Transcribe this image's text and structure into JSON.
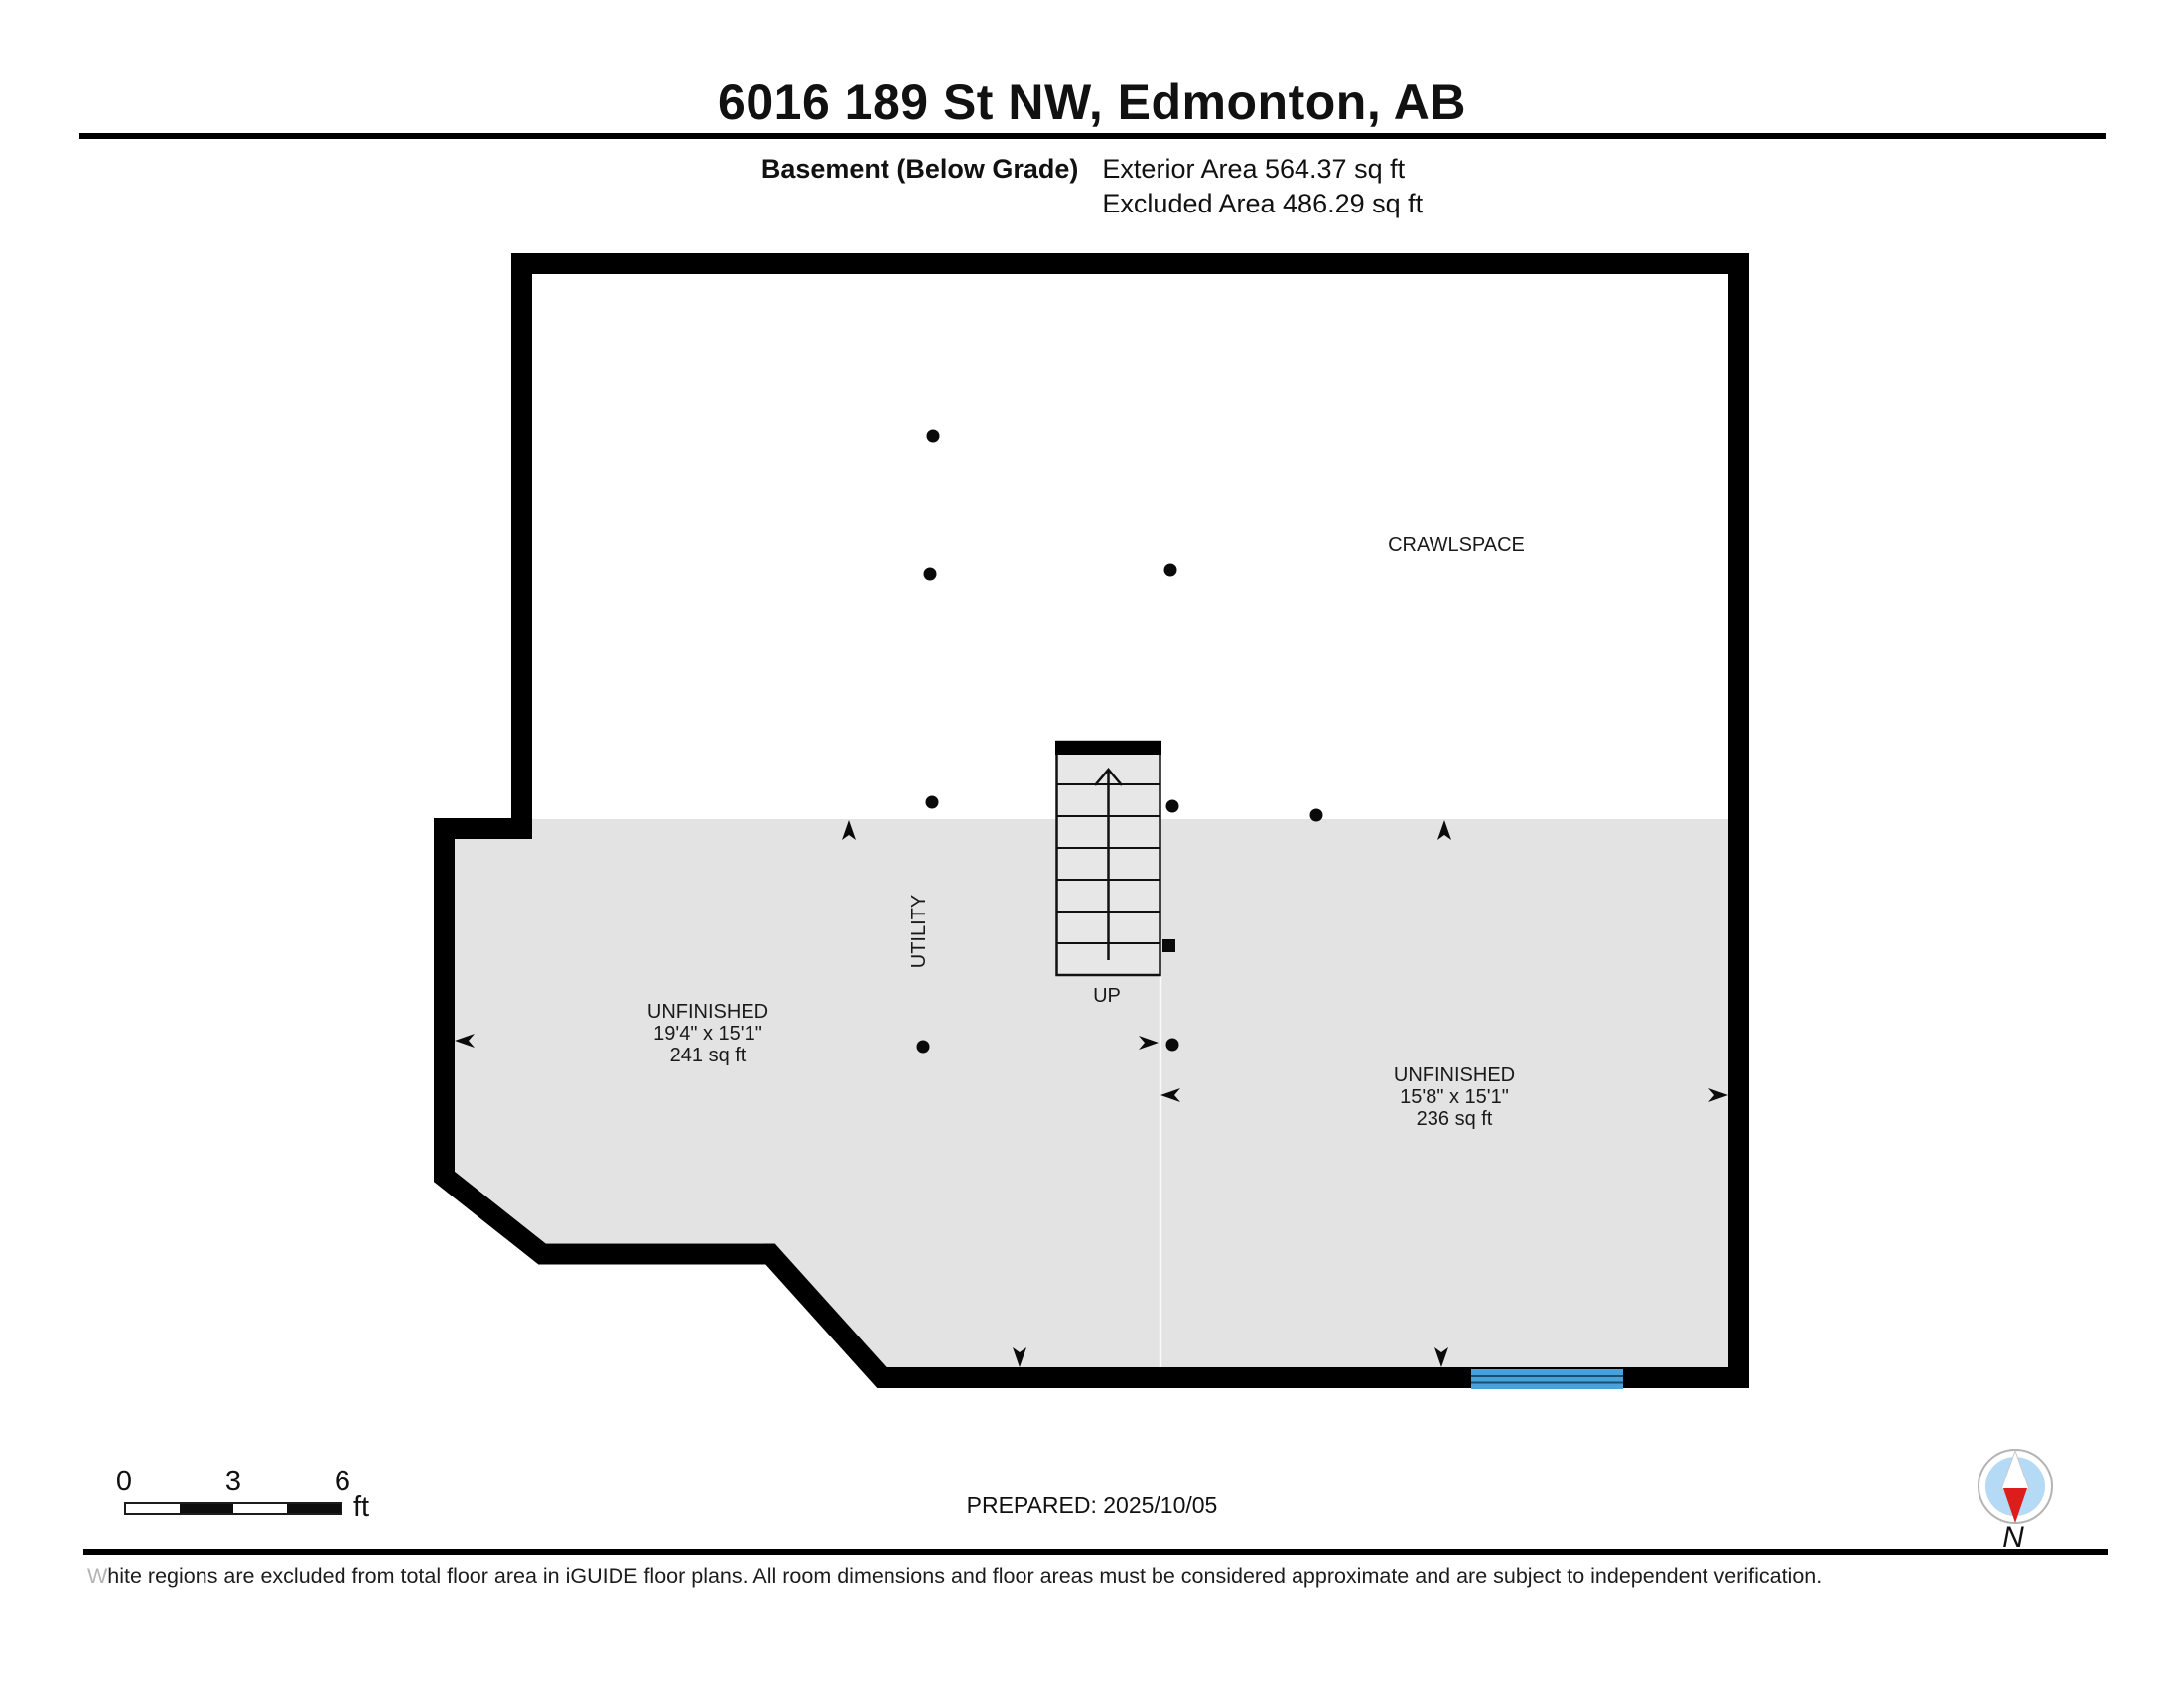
{
  "header": {
    "title": "6016 189 St NW, Edmonton, AB",
    "floor_label": "Basement (Below Grade)",
    "exterior_area": "Exterior Area 564.37 sq ft",
    "excluded_area": "Excluded Area 486.29 sq ft"
  },
  "plan": {
    "crawlspace_label": "CRAWLSPACE",
    "utility_label": "UTILITY",
    "up_label": "UP",
    "room_left": {
      "name": "UNFINISHED",
      "dims": "19'4\" x 15'1\"",
      "area": "241 sq ft"
    },
    "room_right": {
      "name": "UNFINISHED",
      "dims": "15'8\" x 15'1\"",
      "area": "236 sq ft"
    },
    "colors": {
      "below_grade_gray": "#e3e3e3",
      "wall_black": "#000000",
      "window_blue": "#49a1d9",
      "window_line_blue": "#174f77"
    }
  },
  "footer": {
    "scale_ticks": [
      "0",
      "3",
      "6"
    ],
    "scale_unit": "ft",
    "prepared": "PREPARED: 2025/10/05",
    "compass_label": "N",
    "compass_colors": {
      "needle_red": "#dd1c1c",
      "dial_blue": "#b5daf5"
    },
    "disclaimer": "White regions are excluded from total floor area in iGUIDE floor plans. All room dimensions and floor areas must be considered approximate and are subject to independent verification."
  }
}
